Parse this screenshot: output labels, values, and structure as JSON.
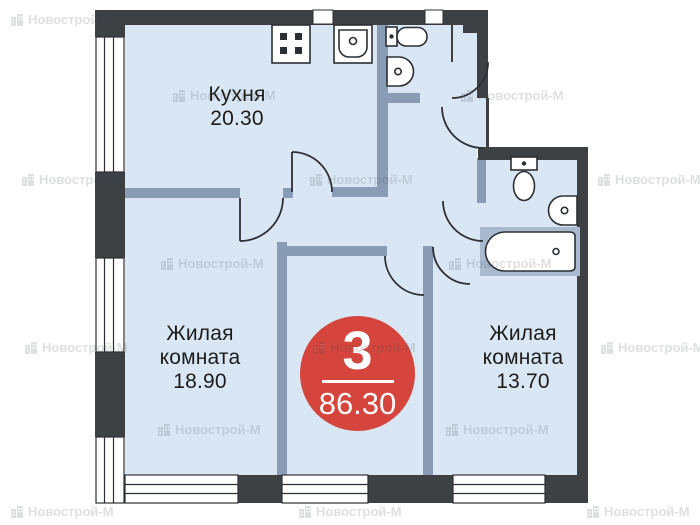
{
  "watermark": {
    "label": "Новострой-М",
    "positions": [
      [
        10,
        12
      ],
      [
        172,
        88
      ],
      [
        460,
        88
      ],
      [
        21,
        172
      ],
      [
        309,
        172
      ],
      [
        597,
        172
      ],
      [
        160,
        256
      ],
      [
        448,
        256
      ],
      [
        24,
        340
      ],
      [
        312,
        340
      ],
      [
        600,
        340
      ],
      [
        157,
        422
      ],
      [
        445,
        422
      ],
      [
        10,
        504
      ],
      [
        298,
        504
      ],
      [
        586,
        504
      ]
    ]
  },
  "rooms": {
    "kitchen": {
      "line1": "Кухня",
      "line2": "20.30"
    },
    "living_left": {
      "line1": "Жилая",
      "line2": "комната",
      "line3": "18.90"
    },
    "living_right": {
      "line1": "Жилая",
      "line2": "комната",
      "line3": "13.70"
    }
  },
  "badge": {
    "rooms": "3",
    "area": "86.30"
  },
  "colors": {
    "wall_dark": "#3d4144",
    "wall_inner": "#8a9bb6",
    "room_fill": "#d9e7f5",
    "tub_deck": "#a9bacf",
    "badge_red": "#d5453d",
    "line": "#2c3034",
    "watermark_gray": "#444a50",
    "label_color": "#1c1c1c"
  }
}
